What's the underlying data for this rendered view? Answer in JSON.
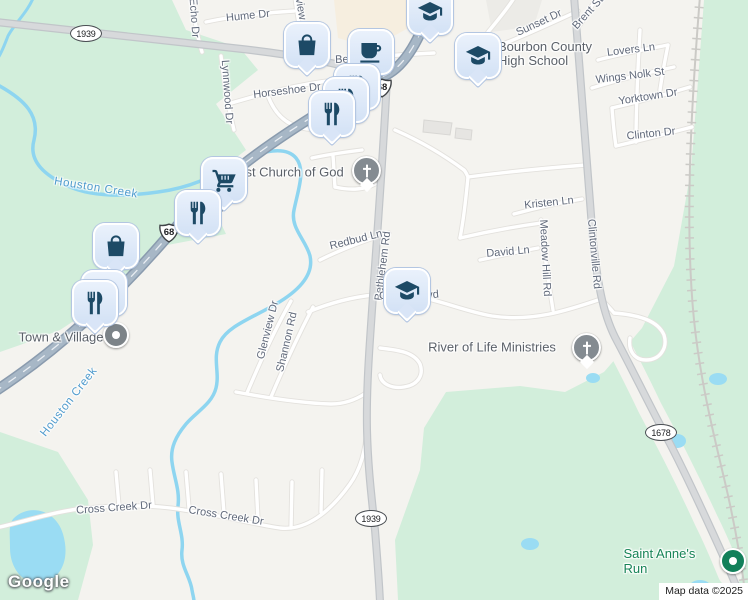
{
  "attribution": "Map data ©2025",
  "logo": "Google",
  "colors": {
    "land": "#f4f3ef",
    "green_area": "#d2eedb",
    "water": "#9adcf3",
    "major_road_fill": "#a7b7c6",
    "major_road_casing": "#8a9bae",
    "secondary_road_fill": "#d7d9db",
    "secondary_road_casing": "#c1c5c9",
    "marker_background": "#d9e6f8",
    "marker_icon": "#1d4a66",
    "street_label": "#60697a",
    "poi_label": "#5b6169",
    "water_label": "#4f9bcd",
    "green_poi_label": "#178457",
    "church_dot": "#848b91",
    "town_dot": "#7c8388",
    "saint_anne_dot": "#12805a"
  },
  "street_labels": [
    {
      "t": "Hume Dr",
      "x": 248,
      "y": 16,
      "r": -6
    },
    {
      "t": "Echo Dr",
      "x": 194,
      "y": 18,
      "r": 86
    },
    {
      "t": "Skyview",
      "x": 299,
      "y": 0,
      "r": 80
    },
    {
      "t": "Lynnwood Dr",
      "x": 227,
      "y": 92,
      "r": 86
    },
    {
      "t": "Horseshoe Dr",
      "x": 287,
      "y": 91,
      "r": -7
    },
    {
      "t": "Bedford Rd",
      "x": 363,
      "y": 59,
      "r": -2
    },
    {
      "t": "Sunset Dr",
      "x": 539,
      "y": 23,
      "r": -25
    },
    {
      "t": "Brent St",
      "x": 588,
      "y": 13,
      "r": -48
    },
    {
      "t": "Lovers Ln",
      "x": 631,
      "y": 50,
      "r": -7
    },
    {
      "t": "Wings Nolk St",
      "x": 630,
      "y": 76,
      "r": -7
    },
    {
      "t": "Yorktown Dr",
      "x": 648,
      "y": 97,
      "r": -9
    },
    {
      "t": "Clinton Dr",
      "x": 651,
      "y": 134,
      "r": -6
    },
    {
      "t": "Kristen Ln",
      "x": 549,
      "y": 203,
      "r": -6
    },
    {
      "t": "David Ln",
      "x": 508,
      "y": 252,
      "r": -5
    },
    {
      "t": "Meadow Hill Rd",
      "x": 545,
      "y": 258,
      "r": 87
    },
    {
      "t": "Clintonville Rd",
      "x": 594,
      "y": 254,
      "r": 85
    },
    {
      "t": "Bethlehem Rd",
      "x": 383,
      "y": 266,
      "r": -83
    },
    {
      "t": "Redbud Ln",
      "x": 356,
      "y": 240,
      "r": -14
    },
    {
      "t": "Glenview Dr",
      "x": 268,
      "y": 330,
      "r": -76
    },
    {
      "t": "Shannon Rd",
      "x": 287,
      "y": 342,
      "r": -77
    },
    {
      "t": "Cross Creek Dr",
      "x": 114,
      "y": 508,
      "r": -4
    },
    {
      "t": "Cross Creek Dr",
      "x": 226,
      "y": 516,
      "r": 9
    }
  ],
  "fragment_labels": [
    {
      "t": "C",
      "x": 383,
      "y": 296,
      "r": 0
    },
    {
      "t": "vd",
      "x": 433,
      "y": 295,
      "r": -5
    }
  ],
  "water_labels": [
    {
      "t": "Houston Creek",
      "x": 96,
      "y": 188,
      "r": 9
    },
    {
      "t": "Houston Creek",
      "x": 69,
      "y": 402,
      "r": -52
    }
  ],
  "poi_labels": [
    {
      "t": "First Church of God",
      "x": 287,
      "y": 172
    },
    {
      "t": "Bourbon County\nHigh School",
      "x": 498,
      "y": 54,
      "anchor": "left"
    },
    {
      "t": "River of Life Ministries",
      "x": 492,
      "y": 347
    },
    {
      "t": "Town & Village",
      "x": 61,
      "y": 337
    },
    {
      "t": "Saint Anne's Run",
      "x": 665,
      "y": 561,
      "color": "green"
    }
  ],
  "shields": [
    {
      "type": "oval",
      "n": "1939",
      "x": 86,
      "y": 33
    },
    {
      "type": "oval",
      "n": "1939",
      "x": 371,
      "y": 518
    },
    {
      "type": "oval",
      "n": "1678",
      "x": 661,
      "y": 432
    },
    {
      "type": "us",
      "n": "68",
      "x": 169,
      "y": 234
    },
    {
      "type": "us",
      "n": "68",
      "x": 382,
      "y": 89
    },
    {
      "type": "us",
      "n": "27",
      "x": 219,
      "y": 205
    }
  ],
  "markers": [
    {
      "icon": "graduation-cap",
      "x": 430,
      "y": 12
    },
    {
      "icon": "shopping-bag",
      "x": 307,
      "y": 45
    },
    {
      "icon": "coffee-cup",
      "x": 371,
      "y": 52
    },
    {
      "icon": "graduation-cap",
      "x": 478,
      "y": 56
    },
    {
      "icon": "restaurant",
      "x": 357,
      "y": 87
    },
    {
      "icon": "restaurant",
      "x": 346,
      "y": 100
    },
    {
      "icon": "restaurant",
      "x": 332,
      "y": 114
    },
    {
      "icon": "shopping-cart",
      "x": 224,
      "y": 180
    },
    {
      "icon": "restaurant",
      "x": 198,
      "y": 213
    },
    {
      "icon": "shopping-bag",
      "x": 116,
      "y": 246
    },
    {
      "icon": "restaurant",
      "x": 104,
      "y": 293
    },
    {
      "icon": "restaurant",
      "x": 95,
      "y": 303
    },
    {
      "icon": "graduation-cap",
      "x": 407,
      "y": 291
    }
  ],
  "poi_dots": [
    {
      "type": "church",
      "x": 366,
      "y": 170
    },
    {
      "type": "church",
      "x": 586,
      "y": 347
    },
    {
      "type": "town-dot",
      "x": 115,
      "y": 334
    },
    {
      "type": "green-dot",
      "x": 732,
      "y": 560
    }
  ]
}
